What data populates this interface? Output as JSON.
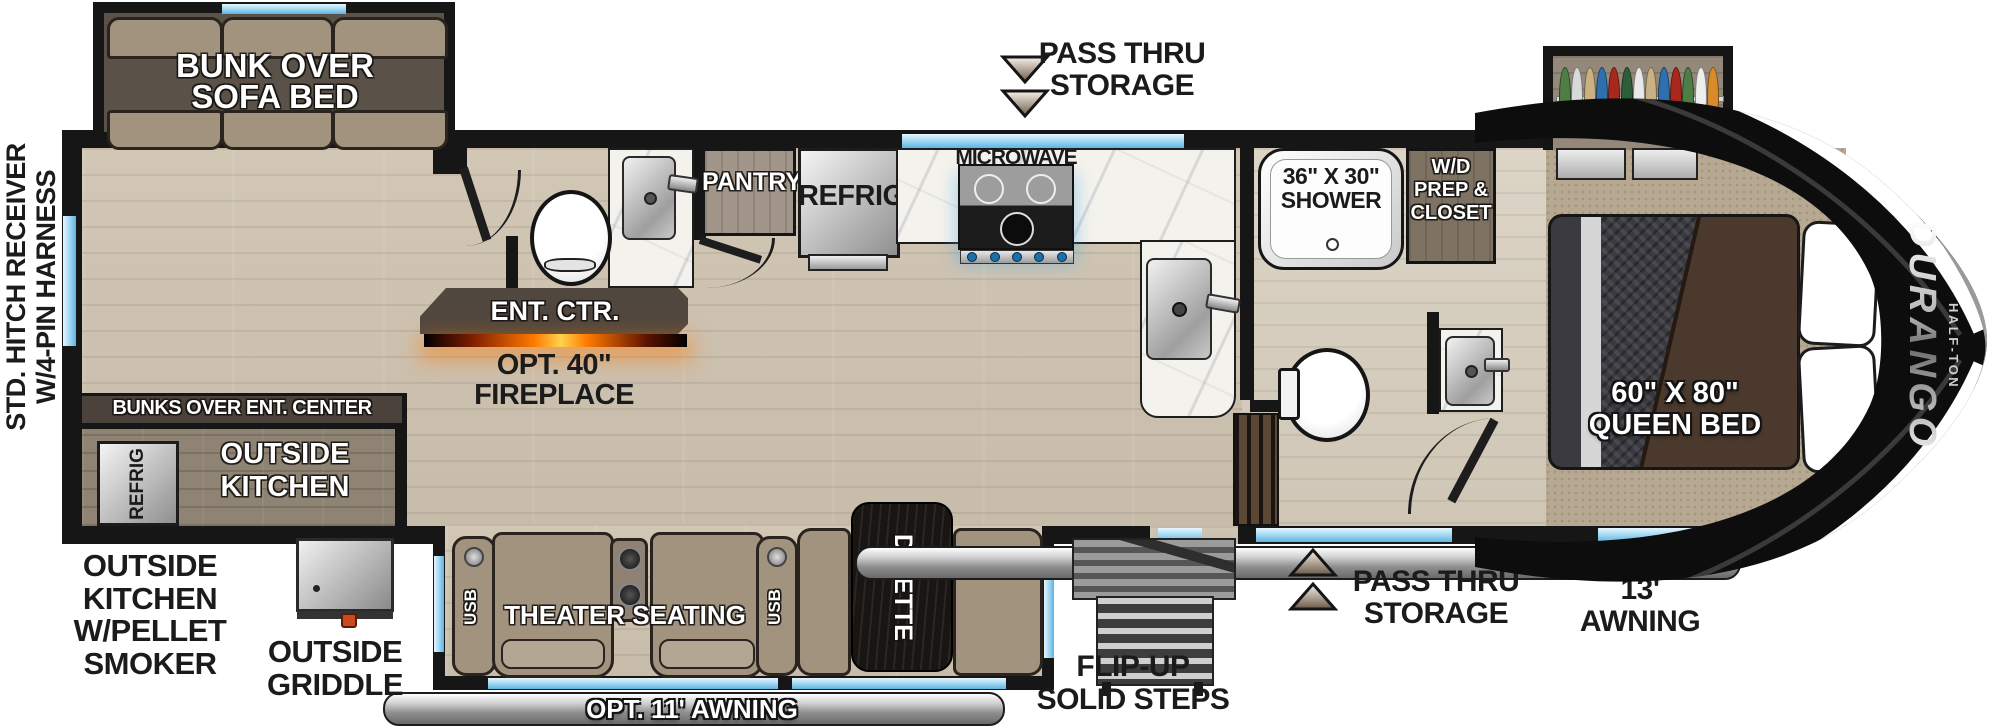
{
  "exterior_labels": {
    "hitch": "STD. HITCH RECEIVER\nW/4-PIN HARNESS",
    "pass_thru_top": "PASS THRU\nSTORAGE",
    "pass_thru_bottom": "PASS THRU\nSTORAGE",
    "awning_13": "13'\nAWNING",
    "awning_opt_11": "OPT. 11' AWNING",
    "flip_up_steps": "FLIP-UP\nSOLID STEPS",
    "outside_kitchen_smoker": "OUTSIDE\nKITCHEN\nW/PELLET\nSMOKER",
    "outside_griddle": "OUTSIDE\nGRIDDLE"
  },
  "interior_labels": {
    "bunk_sofa": "BUNK OVER\nSOFA BED",
    "bunks_over_ent": "BUNKS OVER ENT. CENTER",
    "outside_kitchen_bay": "OUTSIDE\nKITCHEN",
    "outside_refrig": "REFRIG",
    "ent_ctr": "ENT. CTR.",
    "fireplace": "OPT. 40\"\nFIREPLACE",
    "pantry": "PANTRY",
    "refrig": "REFRIG",
    "microwave": "MICROWAVE",
    "shower": "36\" X 30\"\nSHOWER",
    "wd_closet": "W/D\nPREP &\nCLOSET",
    "queen_bed": "60\" X 80\"\nQUEEN BED",
    "theater_seating": "THEATER SEATING",
    "usb": "USB",
    "dinette": "DINETTE"
  },
  "branding": {
    "model": "DURANGO",
    "trim": "HALF-TON"
  },
  "icons": {
    "pass_thru_top_indicator": "double-arrow-down",
    "pass_thru_bottom_indicator": "double-arrow-up"
  },
  "colors": {
    "wall": "#161616",
    "window_blue": "#9bd5f1",
    "wood_floor": "#cdc2b0",
    "carpet": "#b7a892",
    "slide_interior": "#5a5148",
    "cushion_tan": "#a2937f",
    "fireplace_glow": "#ff7a00",
    "awning_chrome": "#d2d2d2"
  },
  "wardrobe_clothes_colors": [
    "#4e7d46",
    "#d9d9d9",
    "#c9b183",
    "#2f6fae",
    "#a8281e",
    "#2e5e38",
    "#e9e9e9",
    "#c9b183",
    "#2f6fae",
    "#a8281e",
    "#4e7d46",
    "#eeeeee",
    "#d98a2b"
  ]
}
